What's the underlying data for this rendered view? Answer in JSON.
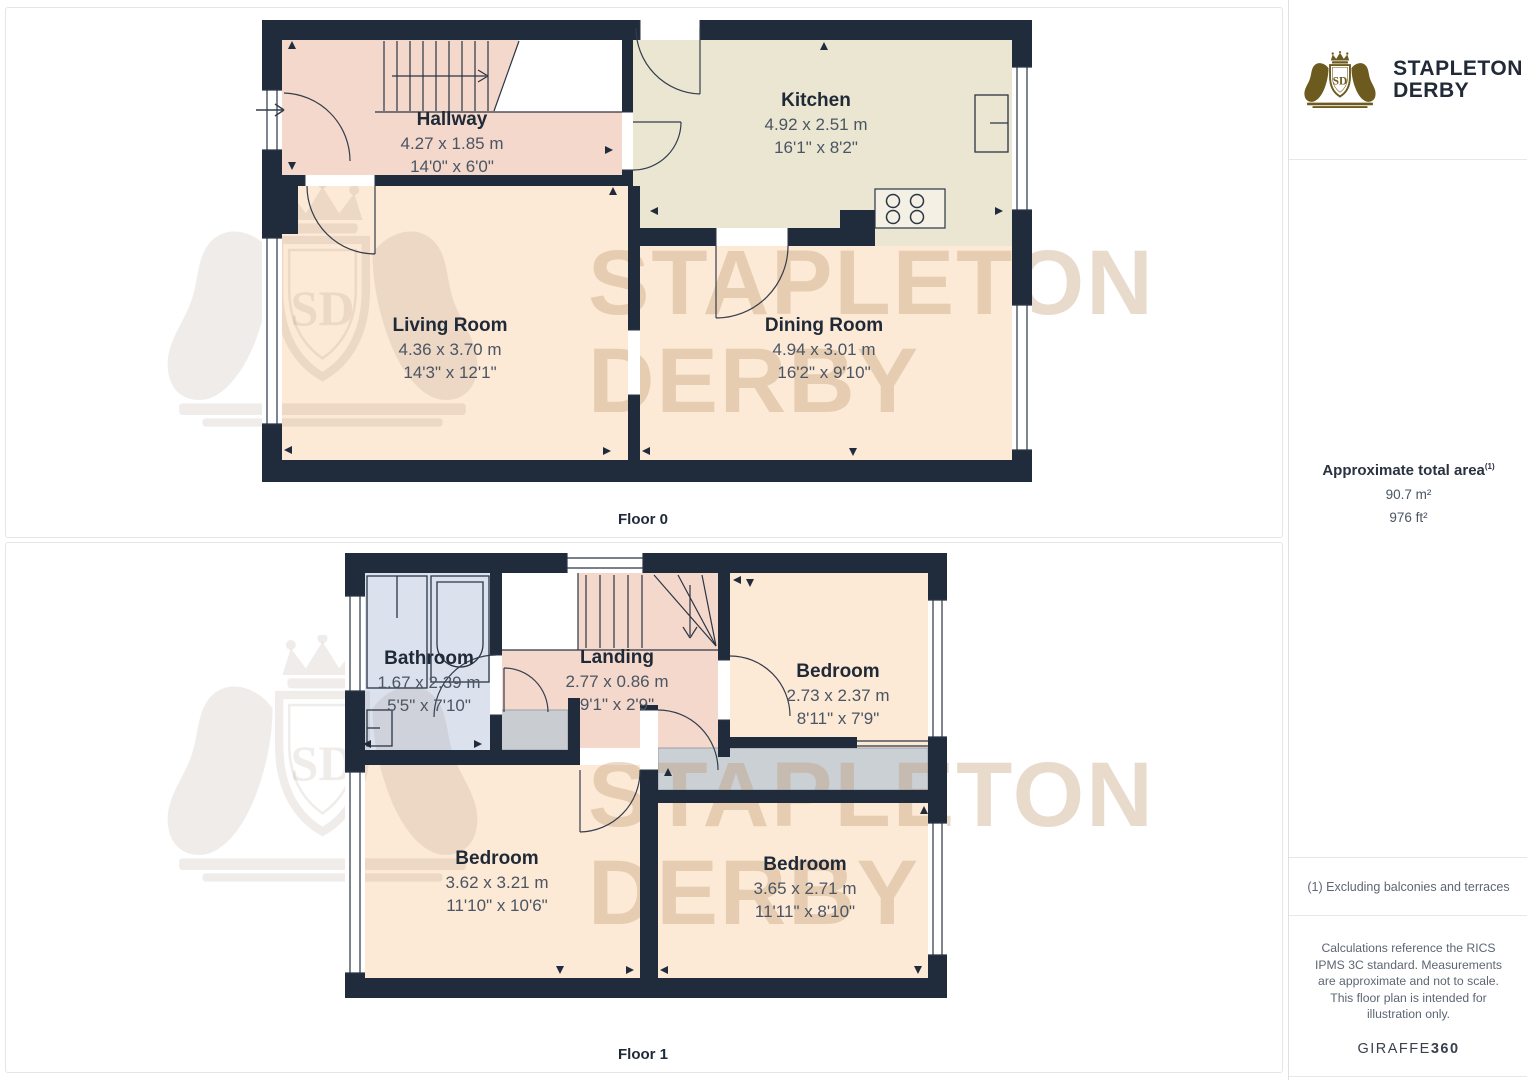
{
  "branding": {
    "logo_line1": "STAPLETON",
    "logo_line2": "DERBY",
    "logo_monogram": "SD"
  },
  "watermark": {
    "line1": "STAPLETON",
    "line2": "DERBY",
    "monogram": "SD"
  },
  "sidebar": {
    "total_area_label": "Approximate total area",
    "total_area_superscript": "(1)",
    "total_area_m2": "90.7 m²",
    "total_area_ft2": "976 ft²",
    "footnote": "(1) Excluding balconies and terraces",
    "disclaimer": "Calculations reference the RICS IPMS 3C standard. Measurements are approximate and not to scale. This floor plan is intended for illustration only.",
    "provider_name": "GIRAFFE",
    "provider_suffix": "360"
  },
  "floors": [
    {
      "label": "Floor 0",
      "rooms": [
        {
          "name": "Hallway",
          "metric": "4.27 x 1.85 m",
          "imperial": "14'0\" x 6'0\""
        },
        {
          "name": "Kitchen",
          "metric": "4.92 x 2.51 m",
          "imperial": "16'1\" x 8'2\""
        },
        {
          "name": "Living Room",
          "metric": "4.36 x 3.70 m",
          "imperial": "14'3\" x 12'1\""
        },
        {
          "name": "Dining Room",
          "metric": "4.94 x 3.01 m",
          "imperial": "16'2\" x 9'10\""
        }
      ]
    },
    {
      "label": "Floor 1",
      "rooms": [
        {
          "name": "Bathroom",
          "metric": "1.67 x 2.39 m",
          "imperial": "5'5\" x 7'10\""
        },
        {
          "name": "Landing",
          "metric": "2.77 x 0.86 m",
          "imperial": "9'1\" x 2'9\""
        },
        {
          "name": "Bedroom",
          "metric": "2.73 x 2.37 m",
          "imperial": "8'11\" x 7'9\""
        },
        {
          "name": "Bedroom",
          "metric": "3.62 x 3.21 m",
          "imperial": "11'10\" x 10'6\""
        },
        {
          "name": "Bedroom",
          "metric": "3.65 x 2.71 m",
          "imperial": "11'11\" x 8'10\""
        }
      ]
    }
  ],
  "colors": {
    "wall": "#202b3b",
    "hallway_fill": "#f3d8cb",
    "kitchen_fill": "#eae6d2",
    "room_fill": "#fce9d6",
    "bathroom_fill": "#dbe2ee",
    "closet_fill": "#c9cdd2",
    "logo_gold": "#6d5a1f",
    "watermark_tan": "#b89364"
  }
}
